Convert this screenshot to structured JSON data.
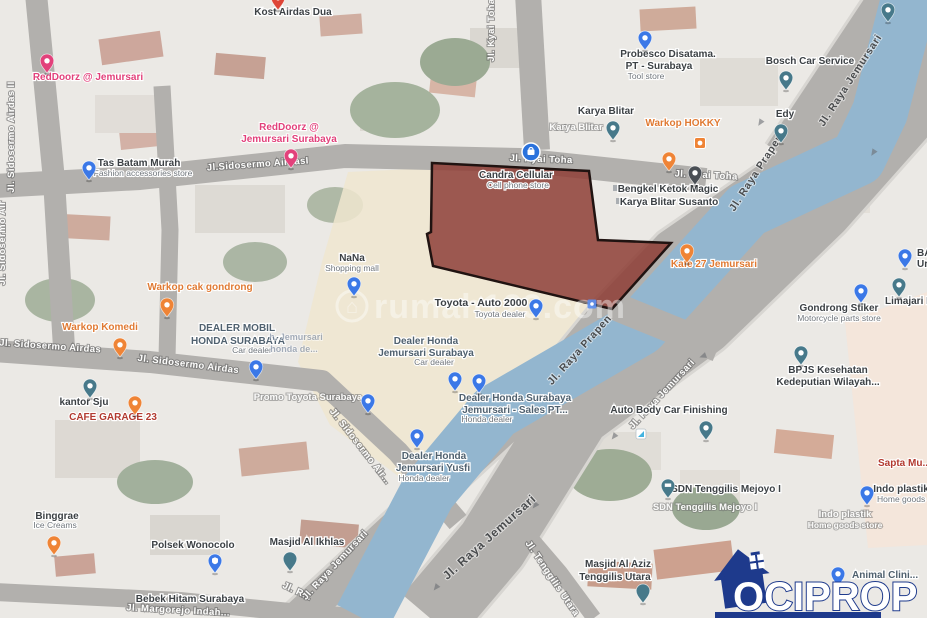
{
  "map": {
    "watermark": "rumah123.com",
    "logo_text": "OCIPROP",
    "parcel_points": "432,163 589,171 598,240 671,243 612,309 433,266 427,234 431,232",
    "colors": {
      "parcel_fill": "#8e3e36",
      "parcel_border": "#201311",
      "canal_blue": "#93b6cf",
      "road_gray": "#b2b0ad",
      "logo_navy": "#1e3a8c",
      "poi_orange": "#e07a33",
      "redDoorz_pink": "#e2417b"
    },
    "labels": [
      {
        "t": "Kost Airdas Dua",
        "x": 293,
        "y": 15,
        "c": "poi"
      },
      {
        "t": "RedDoorz @ Jemursari",
        "x": 88,
        "y": 80,
        "c": "pk"
      },
      {
        "t": "RedDoorz @",
        "x": 289,
        "y": 130,
        "c": "pk"
      },
      {
        "t": "Jemursari Surabaya",
        "x": 289,
        "y": 142,
        "c": "pk"
      },
      {
        "t": "Tas Batam Murah",
        "x": 139,
        "y": 166,
        "c": "poi"
      },
      {
        "t": "Fashion accessories store",
        "x": 143,
        "y": 176,
        "c": "sub"
      },
      {
        "t": "Jl. Sidosermo Airdas II",
        "x": 14,
        "y": 137,
        "c": "rw",
        "r": -90
      },
      {
        "t": "Jl. Sidosermo Air",
        "x": 5,
        "y": 243,
        "c": "rw",
        "r": -90
      },
      {
        "t": "Jl.Sidosermo AirdasI",
        "x": 258,
        "y": 167,
        "c": "rw",
        "r": -4
      },
      {
        "t": "Jl. Kyai Toha",
        "x": 494,
        "y": 30,
        "c": "rw",
        "r": -90
      },
      {
        "t": "Jl. Kyai Toha",
        "x": 541,
        "y": 162,
        "c": "rw",
        "r": 2
      },
      {
        "t": "Jl. Kyai Toha",
        "x": 706,
        "y": 178,
        "c": "rw",
        "r": 3
      },
      {
        "t": "Karya Blitar",
        "x": 606,
        "y": 114,
        "c": "poi"
      },
      {
        "t": "Karya Blitar",
        "x": 576,
        "y": 130,
        "c": "wt"
      },
      {
        "t": "Warkop HOKKY",
        "x": 683,
        "y": 126,
        "c": "or"
      },
      {
        "t": "Probesco Disatama.",
        "x": 668,
        "y": 57,
        "c": "poi"
      },
      {
        "t": "PT - Surabaya",
        "x": 659,
        "y": 69,
        "c": "poi"
      },
      {
        "t": "Tool store",
        "x": 646,
        "y": 79,
        "c": "sub"
      },
      {
        "t": "Bosch Car Service",
        "x": 810,
        "y": 64,
        "c": "poi"
      },
      {
        "t": "Edy",
        "x": 785,
        "y": 117,
        "c": "poi"
      },
      {
        "t": "Jl. Raya Jemursari",
        "x": 853,
        "y": 82,
        "c": "rdk",
        "r": -57
      },
      {
        "t": "Jl. Raya Prapen",
        "x": 759,
        "y": 174,
        "c": "rdk",
        "r": -57
      },
      {
        "t": "Bengkel Ketok Magic",
        "x": 668,
        "y": 192,
        "c": "poi"
      },
      {
        "t": "Karya Blitar Susanto",
        "x": 669,
        "y": 205,
        "c": "poi"
      },
      {
        "t": "Candra Cellular",
        "x": 516,
        "y": 178,
        "c": "poi"
      },
      {
        "t": "Cell phone store",
        "x": 518,
        "y": 188,
        "c": "sub"
      },
      {
        "t": "NaNa",
        "x": 352,
        "y": 261,
        "c": "poi"
      },
      {
        "t": "Shopping mall",
        "x": 352,
        "y": 271,
        "c": "sub"
      },
      {
        "t": "Toyota - Auto 2000",
        "x": 481,
        "y": 306,
        "c": "poi",
        "s": 10.5
      },
      {
        "t": "Toyota dealer",
        "x": 500,
        "y": 317,
        "c": "sub"
      },
      {
        "t": "Kafe 27 Jemursari",
        "x": 714,
        "y": 267,
        "c": "or"
      },
      {
        "t": "BA",
        "x": 917,
        "y": 256,
        "c": "poi",
        "a": "start"
      },
      {
        "t": "Ur",
        "x": 917,
        "y": 267,
        "c": "poi",
        "a": "start"
      },
      {
        "t": "Gondrong Stiker",
        "x": 839,
        "y": 311,
        "c": "poi"
      },
      {
        "t": "Motorcycle parts store",
        "x": 839,
        "y": 321,
        "c": "sub"
      },
      {
        "t": "Limajari R",
        "x": 885,
        "y": 304,
        "c": "poi",
        "a": "start"
      },
      {
        "t": "BPJS Kesehatan",
        "x": 828,
        "y": 373,
        "c": "poi"
      },
      {
        "t": "Kedeputian Wilayah...",
        "x": 828,
        "y": 385,
        "c": "poi"
      },
      {
        "t": "DEALER MOBIL",
        "x": 237,
        "y": 331,
        "c": "biz"
      },
      {
        "t": "HONDA SURABAYA",
        "x": 238,
        "y": 344,
        "c": "biz"
      },
      {
        "t": "Car dealer",
        "x": 252,
        "y": 353,
        "c": "sub"
      },
      {
        "t": "h. Jemursari",
        "x": 296,
        "y": 340,
        "c": "fr"
      },
      {
        "t": "honda de...",
        "x": 294,
        "y": 352,
        "c": "fr"
      },
      {
        "t": "Dealer Honda",
        "x": 426,
        "y": 344,
        "c": "biz"
      },
      {
        "t": "Jemursari Surabaya",
        "x": 426,
        "y": 356,
        "c": "biz"
      },
      {
        "t": "Car dealer",
        "x": 434,
        "y": 365,
        "c": "sub"
      },
      {
        "t": "Dealer Honda Surabaya",
        "x": 515,
        "y": 401,
        "c": "biz"
      },
      {
        "t": "Jemursari - Sales PT...",
        "x": 515,
        "y": 413,
        "c": "biz"
      },
      {
        "t": "Honda dealer",
        "x": 487,
        "y": 422,
        "c": "sub"
      },
      {
        "t": "Dealer Honda",
        "x": 434,
        "y": 459,
        "c": "biz"
      },
      {
        "t": "Jemursari Yusfi",
        "x": 433,
        "y": 471,
        "c": "biz"
      },
      {
        "t": "Honda dealer",
        "x": 424,
        "y": 481,
        "c": "sub"
      },
      {
        "t": "Promo Toyota Surabaya",
        "x": 308,
        "y": 400,
        "c": "wt"
      },
      {
        "t": "Warkop cak gondrong",
        "x": 200,
        "y": 290,
        "c": "or"
      },
      {
        "t": "Warkop Komedi",
        "x": 100,
        "y": 330,
        "c": "or"
      },
      {
        "t": "Jl. Sidosermo Airdas",
        "x": 50,
        "y": 349,
        "c": "rw",
        "r": 4
      },
      {
        "t": "Jl. Sidosermo Airdas",
        "x": 188,
        "y": 367,
        "c": "rw",
        "r": 7
      },
      {
        "t": "Jl. Sidosermo Air...",
        "x": 358,
        "y": 448,
        "c": "rw",
        "r": 52
      },
      {
        "t": "kantor Sju",
        "x": 84,
        "y": 405,
        "c": "poi"
      },
      {
        "t": "CAFE GARAGE 23",
        "x": 113,
        "y": 420,
        "c": "rd"
      },
      {
        "t": "Binggrae",
        "x": 57,
        "y": 519,
        "c": "poi"
      },
      {
        "t": "Ice Creams",
        "x": 55,
        "y": 528,
        "c": "sub"
      },
      {
        "t": "Polsek Wonocolo",
        "x": 193,
        "y": 548,
        "c": "poi"
      },
      {
        "t": "Masjid Al Ikhlas",
        "x": 307,
        "y": 545,
        "c": "poi"
      },
      {
        "t": "Bebek Hitam Surabaya",
        "x": 190,
        "y": 602,
        "c": "poi"
      },
      {
        "t": "Jl. Margorejo Indah...",
        "x": 178,
        "y": 613,
        "c": "rw",
        "r": 3
      },
      {
        "t": "Jl. R...",
        "x": 296,
        "y": 594,
        "c": "rw",
        "r": 25
      },
      {
        "t": "Jl. Raya Jemursari",
        "x": 664,
        "y": 396,
        "c": "rw",
        "r": -47
      },
      {
        "t": "Jl. Raya Jemursari",
        "x": 337,
        "y": 567,
        "c": "rw",
        "r": -47
      },
      {
        "t": "Jl. Raya Jemursari",
        "x": 492,
        "y": 540,
        "c": "rdk",
        "r": -42,
        "s": 12
      },
      {
        "t": "Jl. Tenggilis Utara",
        "x": 550,
        "y": 580,
        "c": "rw",
        "r": 56
      },
      {
        "t": "Jl. Raya Prapen",
        "x": 582,
        "y": 352,
        "c": "rdk",
        "r": -48
      },
      {
        "t": "Auto Body Car Finishing",
        "x": 669,
        "y": 413,
        "c": "poi"
      },
      {
        "t": "SDN Tenggilis Mejoyo I",
        "x": 726,
        "y": 492,
        "c": "poi"
      },
      {
        "t": "SDN Tenggilis Mejoyo I",
        "x": 705,
        "y": 510,
        "c": "wt"
      },
      {
        "t": "Masjid Al Aziz",
        "x": 618,
        "y": 567,
        "c": "poi"
      },
      {
        "t": "Tenggilis Utara",
        "x": 615,
        "y": 580,
        "c": "poi"
      },
      {
        "t": "Indo plastik",
        "x": 901,
        "y": 492,
        "c": "poi"
      },
      {
        "t": "Home goods s...",
        "x": 877,
        "y": 502,
        "c": "sub",
        "a": "start"
      },
      {
        "t": "Indo plastik",
        "x": 845,
        "y": 517,
        "c": "wt"
      },
      {
        "t": "Home goods store",
        "x": 845,
        "y": 528,
        "c": "wt",
        "s": 8.5
      },
      {
        "t": "Sapta Mu...",
        "x": 878,
        "y": 466,
        "c": "rd",
        "a": "start"
      },
      {
        "t": "Animal Clini...",
        "x": 852,
        "y": 578,
        "c": "biz",
        "a": "start"
      }
    ],
    "pins": [
      {
        "t": "red",
        "x": 278,
        "y": 10,
        "n": "kost-airdas-pin"
      },
      {
        "t": "pink",
        "x": 47,
        "y": 73,
        "n": "reddoorz-pin"
      },
      {
        "t": "pink",
        "x": 291,
        "y": 168,
        "n": "reddoorz-surabaya-pin"
      },
      {
        "t": "blue",
        "x": 89,
        "y": 180,
        "n": "tas-batam-pin"
      },
      {
        "t": "blue",
        "x": 645,
        "y": 50,
        "n": "probesco-pin"
      },
      {
        "t": "teal",
        "x": 786,
        "y": 90,
        "n": "bosch-pin"
      },
      {
        "t": "teal",
        "x": 781,
        "y": 143,
        "n": "edy-pin"
      },
      {
        "t": "teal",
        "x": 613,
        "y": 140,
        "n": "karya-blitar-pin"
      },
      {
        "t": "teal",
        "x": 888,
        "y": 22,
        "n": "corner-pin"
      },
      {
        "t": "osq",
        "x": 700,
        "y": 143,
        "n": "warkop-hokky-pin"
      },
      {
        "t": "orange",
        "x": 669,
        "y": 171,
        "n": "restaurant-pin"
      },
      {
        "t": "dark",
        "x": 695,
        "y": 185,
        "n": "bengkel-pin"
      },
      {
        "t": "cblue",
        "x": 531,
        "y": 152,
        "n": "candra-cellular-pin"
      },
      {
        "t": "blue",
        "x": 354,
        "y": 296,
        "n": "nana-pin"
      },
      {
        "t": "blue",
        "x": 536,
        "y": 318,
        "n": "toyota-pin"
      },
      {
        "t": "blue",
        "x": 256,
        "y": 379,
        "n": "dealer-mobil-pin"
      },
      {
        "t": "blue",
        "x": 455,
        "y": 391,
        "n": "dealer-honda-pin"
      },
      {
        "t": "blue",
        "x": 479,
        "y": 393,
        "n": "dealer-honda-sales-pin"
      },
      {
        "t": "blue",
        "x": 368,
        "y": 413,
        "n": "promo-toyota-pin"
      },
      {
        "t": "blue",
        "x": 417,
        "y": 448,
        "n": "yusfi-pin"
      },
      {
        "t": "orange",
        "x": 167,
        "y": 317,
        "n": "warkop-cak-gondrong-pin"
      },
      {
        "t": "orange",
        "x": 120,
        "y": 357,
        "n": "warkop-komedi-pin"
      },
      {
        "t": "orange",
        "x": 687,
        "y": 263,
        "n": "kafe-27-pin"
      },
      {
        "t": "orange",
        "x": 54,
        "y": 555,
        "n": "binggrae-pin"
      },
      {
        "t": "orange",
        "x": 135,
        "y": 415,
        "n": "kantor-sju-orange-pin"
      },
      {
        "t": "teal",
        "x": 90,
        "y": 398,
        "n": "kantor-sju-pin"
      },
      {
        "t": "msq",
        "x": 592,
        "y": 304,
        "n": "mini-marker"
      },
      {
        "t": "blue",
        "x": 861,
        "y": 303,
        "n": "gondrong-stiker-pin"
      },
      {
        "t": "teal",
        "x": 899,
        "y": 297,
        "n": "limajari-pin"
      },
      {
        "t": "blue",
        "x": 905,
        "y": 268,
        "n": "ba-pin"
      },
      {
        "t": "teal",
        "x": 801,
        "y": 365,
        "n": "bpjs-pin"
      },
      {
        "t": "teal",
        "x": 706,
        "y": 440,
        "n": "auto-body-pin"
      },
      {
        "t": "csq",
        "x": 641,
        "y": 434,
        "n": "car-wash-marker"
      },
      {
        "t": "teal",
        "v": "grad",
        "x": 668,
        "y": 498,
        "n": "sdn-school-pin"
      },
      {
        "t": "blue",
        "x": 867,
        "y": 505,
        "n": "indo-plastik-pin"
      },
      {
        "t": "blue",
        "v": "police",
        "x": 215,
        "y": 573,
        "n": "polsek-pin"
      },
      {
        "t": "teal",
        "v": "crescent",
        "x": 290,
        "y": 571,
        "n": "masjid-al-ikhlas-pin"
      },
      {
        "t": "teal",
        "v": "crescent",
        "x": 643,
        "y": 603,
        "n": "masjid-al-aziz-pin"
      },
      {
        "t": "blue",
        "x": 838,
        "y": 586,
        "n": "animal-clinic-pin"
      }
    ]
  }
}
